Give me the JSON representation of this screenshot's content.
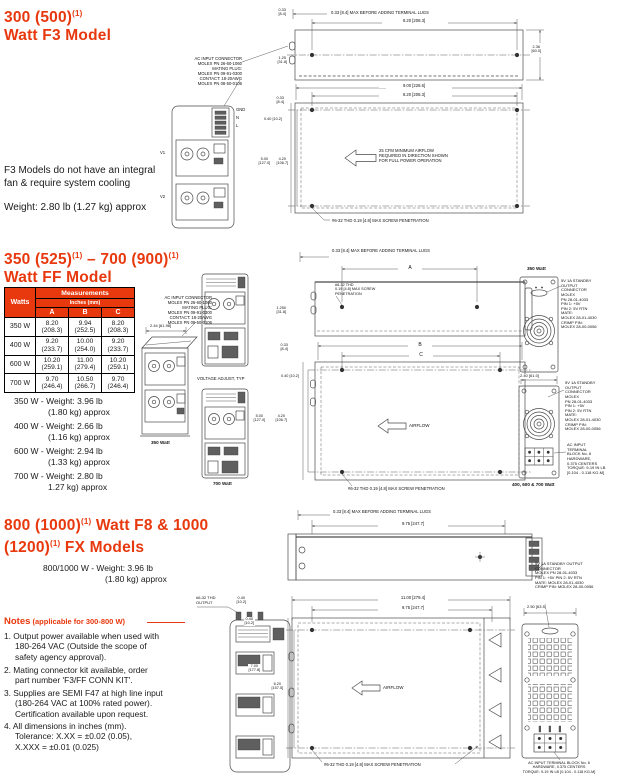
{
  "colors": {
    "accent": "#e8380d",
    "line": "#4a4a4a"
  },
  "f3": {
    "title1": "300 (500)",
    "sup1": "(1)",
    "title2": "Watt F3 Model",
    "body": "F3 Models do not  have an integral\nfan & require  system cooling",
    "weight": "Weight: 2.80 lb (1.27 kg) approx",
    "connector_note": "AC INPUT CONNECTOR\nMOLEX PN 26-60-1060\nMATING PLUG:\nMOLEX PN 09-91-0300\nCONTACT: 18-20AWG\nMOLEX PN 08-50-0106",
    "pins": "GND\nN\nL",
    "out_v1": "V1",
    "out_v2": "V2",
    "dim_lug": "0.33 [8.4] MAX BEFORE ADDING TERMINAL LUGS",
    "dim_820a": "8.20 [208.3]",
    "dim_033t": "0.33\n[8.4]",
    "dim_125": "1.25\n[31.8]",
    "dim_236": "2.36\n[60.0]",
    "dim_900": "9.00 [228.6]",
    "dim_820b": "8.20 [208.3]",
    "dim_033b": "0.33\n[8.4]",
    "dim_040": "0.40 [10.2]",
    "dim_500": "5.00\n[127.0]",
    "dim_420": "4.20\n[106.7]",
    "airflow": "25 CFM MINIMUM AIRFLOW\nREQUIRED IN DIRECTION SHOWN\nFOR FULL POWER OPERATION",
    "screw": "#6-32 THD 0.19 [4.8] MAX SCREW PENETRATION"
  },
  "ff": {
    "title1": "350 (525)",
    "sup1": "(1)",
    "title1b": " – 700 (900)",
    "sup2": "(1)",
    "title2": "Watt FF Model",
    "table": {
      "col_watts": "Watts",
      "col_meas": "Measurements",
      "col_unit": "Inches (mm)",
      "cols": [
        "A",
        "B",
        "C"
      ],
      "rows": [
        {
          "w": "350 W",
          "a": "8.20\n(208.3)",
          "b": "9.94\n(252.5)",
          "c": "8.20\n(208.3)"
        },
        {
          "w": "400 W",
          "a": "9.20\n(233.7)",
          "b": "10.00\n(254.0)",
          "c": "9.20\n(233.7)"
        },
        {
          "w": "600 W",
          "a": "10.20\n(259.1)",
          "b": "11.00\n(279.4)",
          "c": "10.20\n(259.1)"
        },
        {
          "w": "700 W",
          "a": "9.70\n(246.4)",
          "b": "10.50\n(266.7)",
          "c": "9.70\n(246.4)"
        }
      ]
    },
    "weights": [
      "350 W - Weight: 3.96 lb\n(1.80 kg) approx",
      "400 W - Weight: 2.66 lb\n(1.16 kg) approx",
      "600 W - Weight: 2.94 lb\n(1.33 kg) approx",
      "700 W - Weight: 2.80 lb\n1.27 kg) approx"
    ],
    "connector_note": "AC INPUT CONNECTOR\nMOLEX PN 26-60-1060\nMATING PLUG:\nMOLEX PN 09-91-0300\nCONTACT: 18-20AWG\nMOLEX PN 08-50-0106",
    "dim_244": "2.44 [61.98]",
    "label_350": "350 Watt",
    "volt_adjust": "VOLTAGE ADJUST, TYP",
    "label_700": "700 Watt",
    "dim_lug": "0.33 [8.4] MAX BEFORE ADDING TERMINAL LUGS",
    "dim_A": "A",
    "dim_B": "B",
    "dim_C": "C",
    "screw_callout": "#6-32 THD\n0.19 [4.8] MAX SCREW\nPENETRATION",
    "dim_1250": "1.250\n[31.8]",
    "dim_033": "0.33\n[8.4]",
    "dim_040": "0.40 [10.2]",
    "dim_500": "5.00\n[127.0]",
    "dim_420": "4.20\n[106.7]",
    "airflow": "AIRFLOW",
    "screw": "#6-32 THD 0.19 [4.8] MAX SCREW PENETRATION",
    "fan1_label": "350 Watt",
    "standby1": "5V 1A STANDBY\nOUTPUT\nCONNECTOR\nMOLEX\nPN 28-01-4033\nPIN 1: +5V\nPIN 2: 5V RTN\nMATE:\nMOLEX 28-01-4030\nCRIMP PIN:\nMOLEX 28-00-0056",
    "dim_240": "2.40 [61.0]",
    "standby2": "5V 1A STANDBY\nOUTPUT\nCONNECTOR\nMOLEX\nPN 28-01-4033\nPIN 1: +5V\nPIN 2: 5V RTN\nMATE:\nMOLEX 28-01-4030\nCRIMP PIN:\nMOLEX 28-00-0056",
    "ac_input": "AC INPUT\nTERMINAL\nBLOCK No. 6\nHARDWARE,\n0.375 CENTERS\nTORQUE: 9-19 IN LB\n[0.104 - 0.118 KG-M]",
    "fan2_label": "400, 600 & 700 Watt"
  },
  "fx": {
    "title1": "800 (1000)",
    "sup1": "(1)",
    "title1b": " Watt F8 & 1000",
    "title2a": "(1200)",
    "sup2": "(1)",
    "title2b": " FX Models",
    "weight": "800/1000 W - Weight: 3.96 lb\n(1.80 kg) approx",
    "output_label": "#6-32 THD\nOUTPUT",
    "dim_lug": "0.33 [8.4] MAX BEFORE ADDING TERMINAL LUGS",
    "dim_975a": "9.75 [247.7]",
    "standby": "5V 1A STANDBY OUTPUT\nCONNECTOR\nMOLEX PN 28-01-4033\nPIN 1: +5V PIN 2: 5V RTN\nMATE: MOLEX 28-01-4030\nCRIMP PIN: MOLEX 28-00-0056",
    "dim_250": "2.50 [63.5]",
    "dim_1100": "11.00 [279.4]",
    "dim_975b": "9.75 [247.7]",
    "dim_040a": "0.40\n[10.2]",
    "dim_040b": "0.40\n[10.2]",
    "dim_700": "7.00\n[177.8]",
    "dim_620": "6.20\n[157.5]",
    "airflow": "AIRFLOW",
    "screw": "#6-32 THD 0.19 [4.8] MAX SCREW PENETRATION",
    "ac_input": "AC INPUT TERMINAL BLOCK No. 6\nHARDWARE, 0.375 CENTERS\nTORQUE: 9-19 IN LB [0.104 - 0.118 KG-M]"
  },
  "notes": {
    "title": "Notes",
    "scope": " (applicable for 300-800 W)",
    "items": [
      "1. Output power available when used with\n180-264 VAC (Outside the scope of\nsafety agency approval).",
      "2. Mating connector kit available, order\npart number 'F3/FF CONN KIT'.",
      "3. Supplies are SEMI F47 at high line input\n(180-264 VAC at 100% rated power).\nCertification available upon request.",
      "4. All dimensions in inches (mm).\nTolerance: X.XX = ±0.02 (0.05),\nX.XXX = ±0.01 (0.025)"
    ]
  }
}
